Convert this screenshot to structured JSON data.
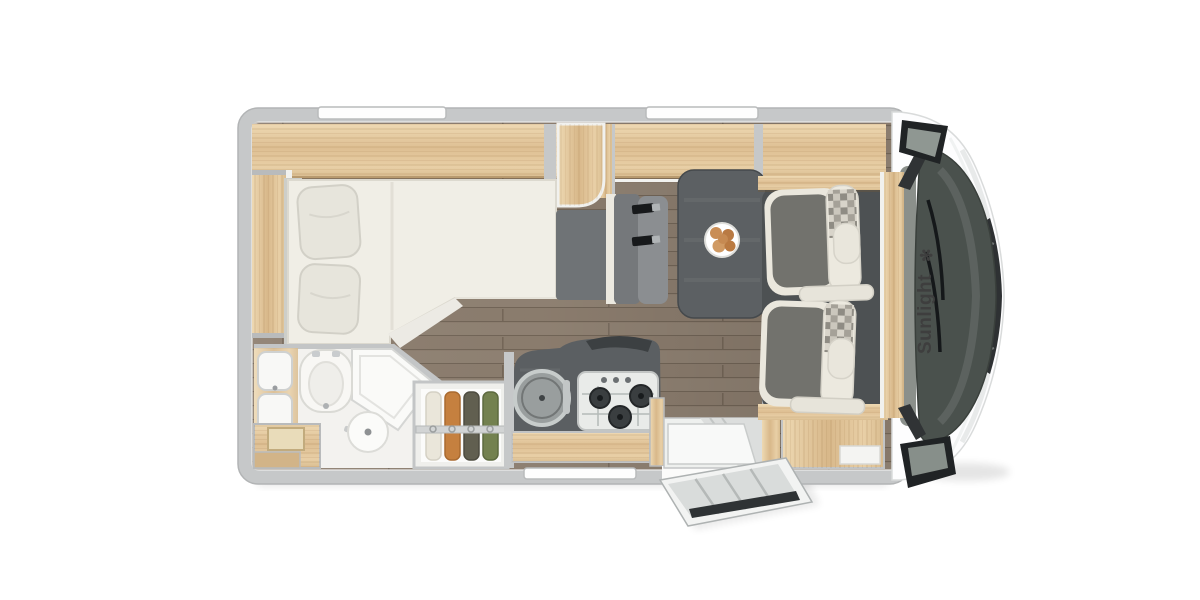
{
  "brand": {
    "name": "Sunlight",
    "logo_glyph": "✻"
  },
  "colors": {
    "background": "#ffffff",
    "body_wall": "#c6c8c9",
    "wood_light": "#e3cba3",
    "floor_plank": "#8d7e6f",
    "table_dark": "#5c6063",
    "counter_dark": "#5b5f62",
    "bed_cream": "#f0eee6",
    "upholstery_cream": "#eae7dd",
    "upholstery_gray": "#72726d",
    "cab_mat": "#4d5153",
    "cab_glass": "#4a514d",
    "mirror_black": "#202325",
    "clothes_orange": "#c5803f",
    "clothes_green": "#73814f"
  }
}
